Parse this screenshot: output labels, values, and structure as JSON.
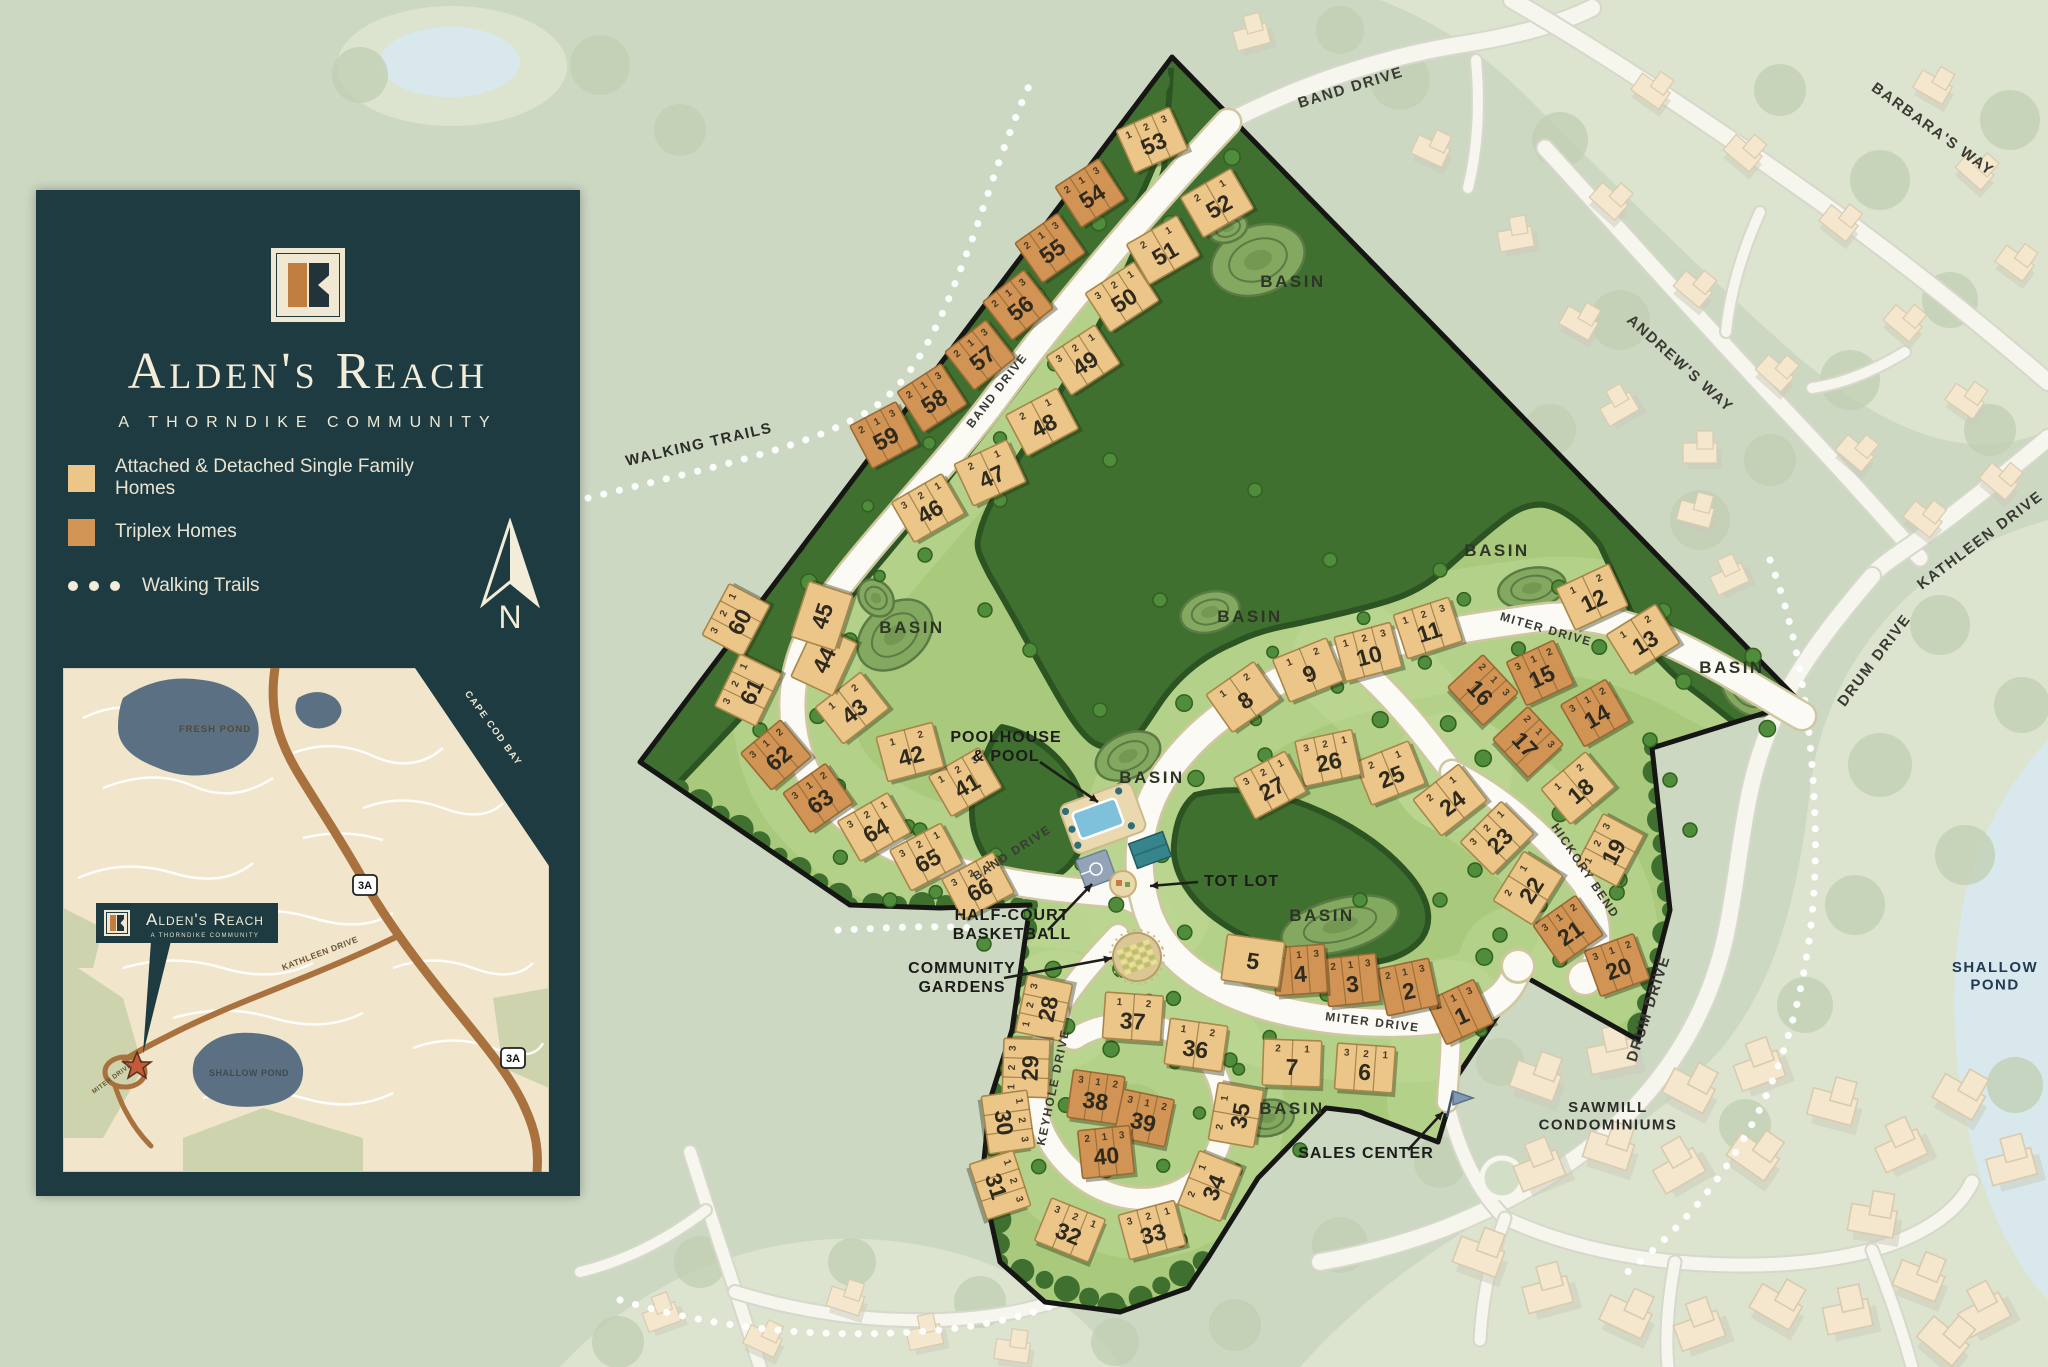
{
  "app": {
    "name": "Alden's Reach community site plan"
  },
  "panel": {
    "title": "Alden's Reach",
    "subtitle": "A THORNDIKE COMMUNITY",
    "legend": [
      {
        "label": "Attached & Detached Single Family Homes",
        "swatch": "tan"
      },
      {
        "label": "Triplex Homes",
        "swatch": "orange"
      },
      {
        "label": "Walking Trails",
        "swatch": "dots"
      }
    ],
    "north_label": "N"
  },
  "inset": {
    "callout_title": "Alden's Reach",
    "callout_subtitle": "A THORNDIKE COMMUNITY",
    "labels": {
      "fresh_pond": "FRESH POND",
      "cape_cod_bay": "CAPE COD BAY",
      "shallow_pond": "SHALLOW POND",
      "kathleen_drive": "KATHLEEN DRIVE",
      "miter_drive": "MITER DRIVE",
      "route_badge": "3A"
    }
  },
  "map": {
    "basin_label": "BASIN",
    "basin_positions": [
      [
        1293,
        287
      ],
      [
        912,
        633
      ],
      [
        1250,
        622
      ],
      [
        1497,
        556
      ],
      [
        1152,
        783
      ],
      [
        1732,
        673
      ],
      [
        1322,
        921
      ],
      [
        1292,
        1114
      ]
    ],
    "road_labels": [
      {
        "text": "BAND DRIVE",
        "x": 1352,
        "y": 92,
        "rot": -17,
        "size": 15
      },
      {
        "text": "BAND DRIVE",
        "x": 1000,
        "y": 393,
        "rot": -52,
        "size": 12
      },
      {
        "text": "BAND DRIVE",
        "x": 1014,
        "y": 856,
        "rot": -33,
        "size": 12
      },
      {
        "text": "MITER DRIVE",
        "x": 1545,
        "y": 633,
        "rot": 16,
        "size": 12
      },
      {
        "text": "MITER DRIVE",
        "x": 1372,
        "y": 1026,
        "rot": 7,
        "size": 12
      },
      {
        "text": "KEYHOLE DRIVE",
        "x": 1057,
        "y": 1088,
        "rot": -78,
        "size": 12
      },
      {
        "text": "HICKORY BEND",
        "x": 1582,
        "y": 873,
        "rot": 56,
        "size": 12
      },
      {
        "text": "BARBARA'S WAY",
        "x": 1930,
        "y": 133,
        "rot": 36,
        "size": 15
      },
      {
        "text": "ANDREW'S WAY",
        "x": 1677,
        "y": 367,
        "rot": 42,
        "size": 15
      },
      {
        "text": "KATHLEEN DRIVE",
        "x": 1983,
        "y": 544,
        "rot": -37,
        "size": 15
      },
      {
        "text": "DRUM DRIVE",
        "x": 1878,
        "y": 663,
        "rot": -53,
        "size": 15
      },
      {
        "text": "DRUM DRIVE",
        "x": 1653,
        "y": 1010,
        "rot": -72,
        "size": 15
      }
    ],
    "amenity_labels": [
      {
        "text": "POOLHOUSE\n& POOL",
        "x": 1006,
        "y": 742
      },
      {
        "text": "TOT LOT",
        "x": 1204,
        "y": 886,
        "anchor": "start"
      },
      {
        "text": "HALF-COURT\nBASKETBALL",
        "x": 1012,
        "y": 920
      },
      {
        "text": "COMMUNITY\nGARDENS",
        "x": 962,
        "y": 973
      },
      {
        "text": "SALES CENTER",
        "x": 1366,
        "y": 1158
      }
    ],
    "area_labels": [
      {
        "text": "SAWMILL\nCONDOMINIUMS",
        "x": 1608,
        "y": 1112
      },
      {
        "text": "SHALLOW\nPOND",
        "x": 1995,
        "y": 972,
        "color": "#223a52"
      },
      {
        "text": "WALKING TRAILS",
        "x": 700,
        "y": 449,
        "rot": -13
      }
    ],
    "lots": [
      [
        1,
        "t",
        1460,
        1012,
        -25,
        "213"
      ],
      [
        2,
        "t",
        1408,
        987,
        -12,
        "213"
      ],
      [
        3,
        "t",
        1352,
        980,
        -6,
        "213"
      ],
      [
        4,
        "t",
        1300,
        970,
        -4,
        "213"
      ],
      [
        5,
        "s",
        1253,
        961,
        8,
        ""
      ],
      [
        6,
        "s",
        1365,
        1068,
        4,
        "321"
      ],
      [
        7,
        "s",
        1292,
        1063,
        2,
        "21"
      ],
      [
        8,
        "s",
        1243,
        697,
        -35,
        "12"
      ],
      [
        9,
        "s",
        1308,
        670,
        -22,
        "12"
      ],
      [
        10,
        "s",
        1368,
        652,
        -15,
        "123"
      ],
      [
        11,
        "s",
        1428,
        628,
        -18,
        "123"
      ],
      [
        12,
        "s",
        1592,
        597,
        -25,
        "12"
      ],
      [
        13,
        "s",
        1643,
        639,
        -32,
        "12"
      ],
      [
        14,
        "t",
        1595,
        713,
        -30,
        "312"
      ],
      [
        15,
        "t",
        1540,
        673,
        -25,
        "312"
      ],
      [
        16,
        "t",
        1483,
        690,
        47,
        "213"
      ],
      [
        17,
        "t",
        1528,
        742,
        47,
        "213"
      ],
      [
        18,
        "s",
        1578,
        788,
        -40,
        "12"
      ],
      [
        19,
        "s",
        1610,
        850,
        -62,
        "123"
      ],
      [
        20,
        "t",
        1617,
        965,
        -20,
        "312"
      ],
      [
        21,
        "t",
        1568,
        930,
        -35,
        "312"
      ],
      [
        22,
        "s",
        1528,
        888,
        -58,
        "21"
      ],
      [
        23,
        "s",
        1497,
        838,
        -45,
        "321"
      ],
      [
        24,
        "s",
        1450,
        800,
        -38,
        "21"
      ],
      [
        25,
        "s",
        1390,
        773,
        -22,
        "21"
      ],
      [
        26,
        "s",
        1328,
        758,
        -12,
        "321"
      ],
      [
        27,
        "s",
        1270,
        785,
        -28,
        "321"
      ],
      [
        28,
        "s",
        1044,
        1008,
        -78,
        "123"
      ],
      [
        29,
        "s",
        1026,
        1068,
        -88,
        "123"
      ],
      [
        30,
        "s",
        1008,
        1122,
        82,
        "123"
      ],
      [
        31,
        "s",
        1000,
        1185,
        72,
        "123"
      ],
      [
        32,
        "s",
        1070,
        1230,
        22,
        "321"
      ],
      [
        33,
        "s",
        1152,
        1230,
        -15,
        "321"
      ],
      [
        34,
        "s",
        1210,
        1186,
        -68,
        "21"
      ],
      [
        35,
        "s",
        1236,
        1115,
        -80,
        "21"
      ],
      [
        36,
        "s",
        1196,
        1045,
        8,
        "12"
      ],
      [
        37,
        "s",
        1133,
        1017,
        4,
        "12"
      ],
      [
        38,
        "t",
        1096,
        1097,
        8,
        "312"
      ],
      [
        39,
        "t",
        1144,
        1118,
        12,
        "312"
      ],
      [
        40,
        "t",
        1106,
        1152,
        -6,
        "213"
      ],
      [
        41,
        "s",
        965,
        782,
        -30,
        "123"
      ],
      [
        42,
        "s",
        910,
        752,
        -15,
        "12"
      ],
      [
        43,
        "s",
        852,
        708,
        -38,
        "12"
      ],
      [
        44,
        "s",
        824,
        660,
        -65,
        ""
      ],
      [
        45,
        "s",
        822,
        616,
        -72,
        ""
      ],
      [
        46,
        "s",
        928,
        508,
        -30,
        "321"
      ],
      [
        47,
        "s",
        990,
        473,
        -25,
        "21"
      ],
      [
        48,
        "s",
        1042,
        422,
        -28,
        "21"
      ],
      [
        49,
        "s",
        1083,
        360,
        -33,
        "321"
      ],
      [
        50,
        "s",
        1122,
        297,
        -33,
        "321"
      ],
      [
        51,
        "s",
        1163,
        250,
        -30,
        "21"
      ],
      [
        52,
        "s",
        1217,
        203,
        -30,
        "21"
      ],
      [
        53,
        "s",
        1152,
        140,
        -24,
        "123"
      ],
      [
        54,
        "t",
        1090,
        193,
        -33,
        "213"
      ],
      [
        55,
        "t",
        1050,
        248,
        -35,
        "213"
      ],
      [
        56,
        "t",
        1018,
        305,
        -38,
        "213"
      ],
      [
        57,
        "t",
        980,
        355,
        -38,
        "213"
      ],
      [
        58,
        "t",
        932,
        398,
        -33,
        "213"
      ],
      [
        59,
        "t",
        884,
        435,
        -28,
        "213"
      ],
      [
        60,
        "s",
        736,
        620,
        -62,
        "321"
      ],
      [
        61,
        "s",
        748,
        690,
        -64,
        "321"
      ],
      [
        62,
        "t",
        776,
        755,
        -40,
        "312"
      ],
      [
        63,
        "t",
        818,
        798,
        -35,
        "312"
      ],
      [
        64,
        "s",
        874,
        827,
        -30,
        "321"
      ],
      [
        65,
        "s",
        926,
        857,
        -28,
        "321"
      ],
      [
        66,
        "s",
        978,
        886,
        -28,
        "321"
      ]
    ]
  },
  "colors": {
    "panel_bg": "#1d3b41",
    "cream": "#f2ecd9",
    "tan": "#ecc688",
    "orange": "#d29455",
    "site_green": "#a9c97d",
    "site_light": "#bdd792",
    "forest": "#3f7030",
    "forest_dark": "#2c5423",
    "road_white": "#fbfaf4",
    "road_edge": "#cfc7a0",
    "offsite_bg": "#cdd8c3",
    "offsite_light": "#dee6d1",
    "house": "#f5e7cd",
    "house_stroke": "#d9cbaf",
    "pond": "#d8e8ec",
    "inset_bg": "#f1e5cc",
    "inset_water": "#5b7183",
    "inset_road": "#a9713d",
    "boundary": "#161614",
    "basin": "#83a961",
    "label": "#23241f",
    "pool": "#7fc0da",
    "tree": "#4f8c3b"
  }
}
